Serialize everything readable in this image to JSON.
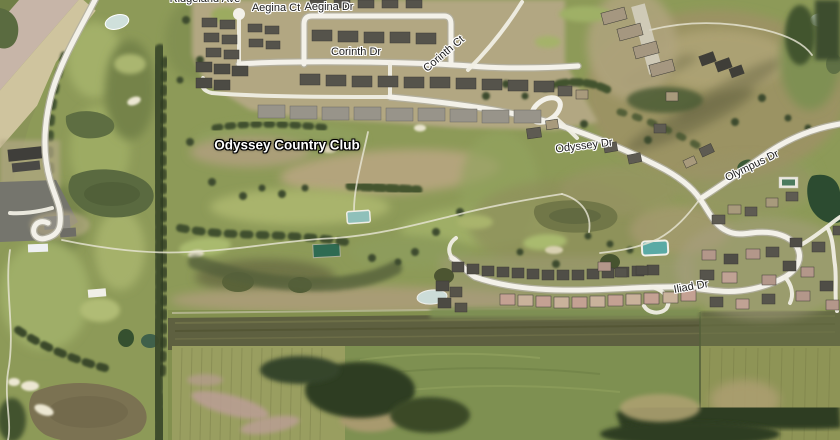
{
  "map": {
    "road_labels": [
      {
        "id": "ridgeland-ave",
        "text": "Ridgeland Ave"
      },
      {
        "id": "aegina-ct",
        "text": "Aegina Ct"
      },
      {
        "id": "aegina-dr",
        "text": "Aegina Dr"
      },
      {
        "id": "corinth-dr",
        "text": "Corinth Dr"
      },
      {
        "id": "corinth-ct",
        "text": "Corinth Ct"
      },
      {
        "id": "odyssey-dr",
        "text": "Odyssey Dr"
      },
      {
        "id": "olympus-dr",
        "text": "Olympus Dr"
      },
      {
        "id": "iliad-dr",
        "text": "Iliad Dr"
      }
    ],
    "poi_labels": [
      {
        "id": "odyssey-country-club",
        "text": "Odyssey Country Club"
      }
    ],
    "colors": {
      "road": "#f3f1e9",
      "road_label_text": "#1c1c1c",
      "road_label_halo": "#ffffff",
      "poi_label_text": "#ffffff",
      "poi_label_halo": "#000000",
      "fairway_green": "#9dac64",
      "rough_olive": "#7d8a4e",
      "tree_dark_green": "#36452a",
      "dirt_tan": "#b3a67c",
      "pond_olive": "#5a6a40",
      "pond_teal": "#5aaaa5"
    }
  }
}
